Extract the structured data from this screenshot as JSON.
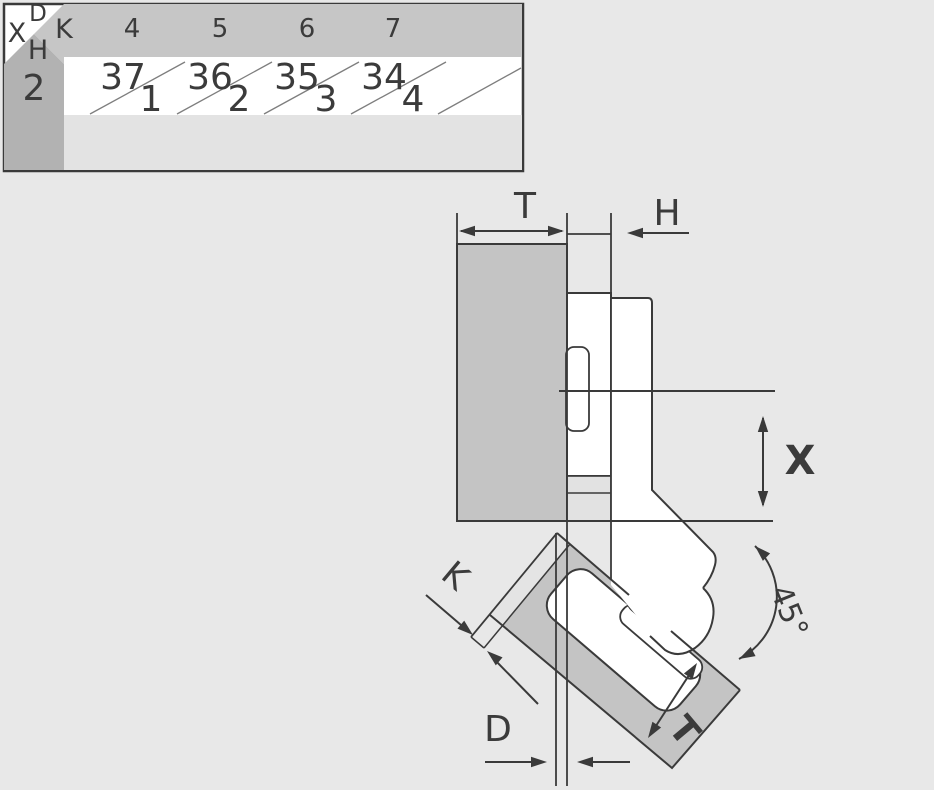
{
  "table": {
    "corner": {
      "top": "D",
      "left": "X",
      "right": "K",
      "bottom": "H"
    },
    "row_header": "2",
    "columns": [
      "4",
      "5",
      "6",
      "7"
    ],
    "cells": [
      {
        "top": "37",
        "bottom": "1"
      },
      {
        "top": "36",
        "bottom": "2"
      },
      {
        "top": "35",
        "bottom": "3"
      },
      {
        "top": "34",
        "bottom": "4"
      }
    ]
  },
  "diagram": {
    "labels": {
      "panel_thickness": "T",
      "h_dim": "H",
      "x_dim": "X",
      "k_dim": "K",
      "d_dim": "D",
      "door_thickness": "T",
      "angle": "45°"
    }
  },
  "colors": {
    "background": "#e8e8e8",
    "panel_gray": "#c4c4c4",
    "header_gray": "#c6c6c6",
    "column_gray": "#b2b2b2",
    "bottom_row_gray": "#e3e3e3",
    "line": "#3a3a3a",
    "white": "#ffffff"
  }
}
